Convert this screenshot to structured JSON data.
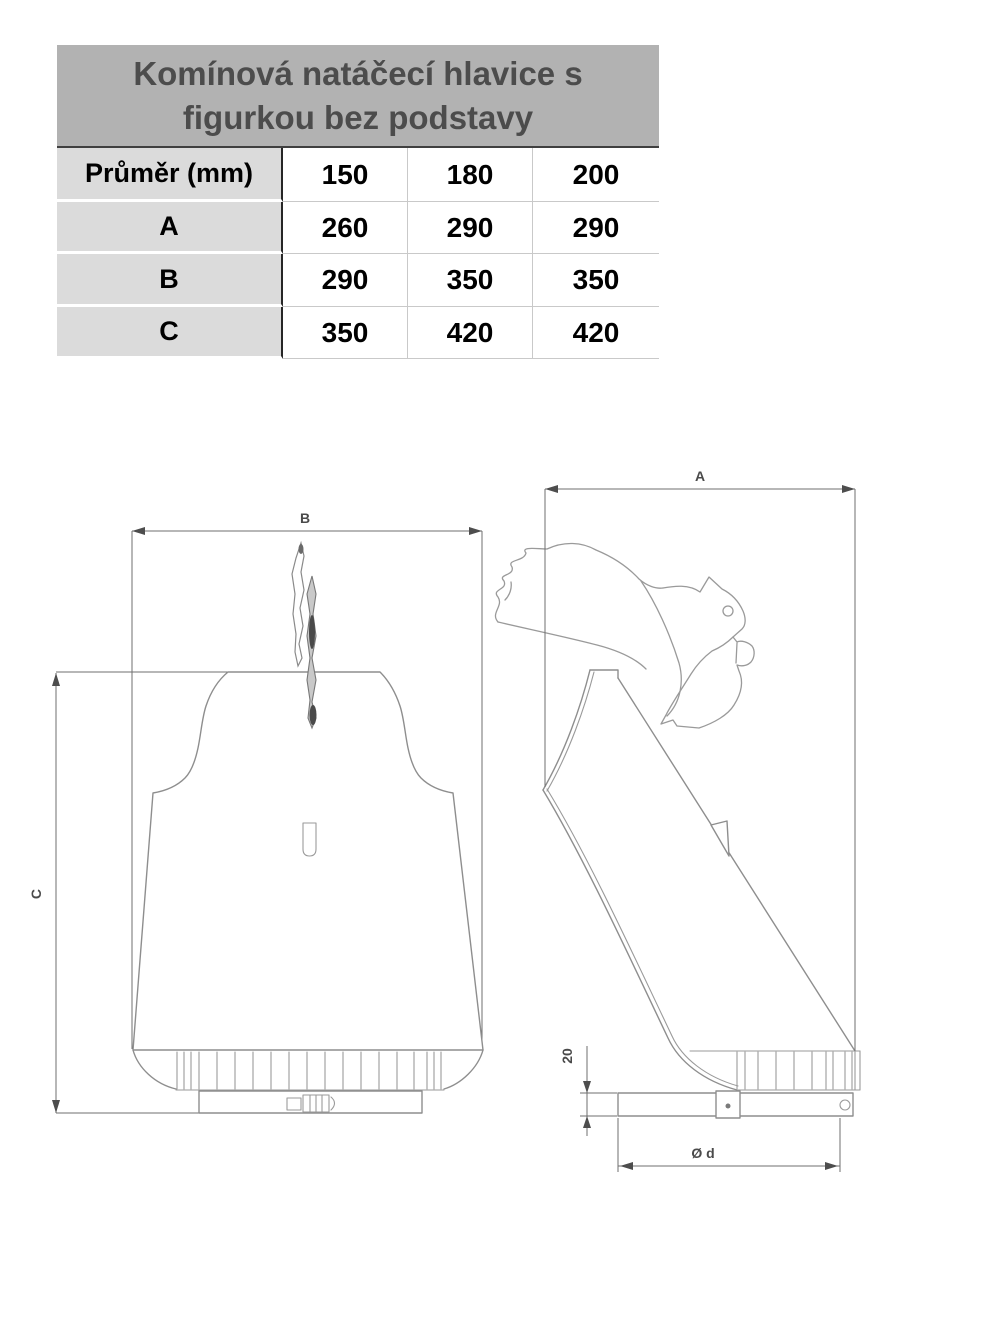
{
  "table": {
    "title": "Komínová natáčecí hlavice s figurkou bez podstavy",
    "columns_header": {
      "label": "Průměr (mm)",
      "values": [
        "150",
        "180",
        "200"
      ]
    },
    "rows": [
      {
        "label": "A",
        "values": [
          "260",
          "290",
          "290"
        ]
      },
      {
        "label": "B",
        "values": [
          "290",
          "350",
          "350"
        ]
      },
      {
        "label": "C",
        "values": [
          "350",
          "420",
          "420"
        ]
      }
    ]
  },
  "drawing": {
    "front_view": {
      "width_dim": "B",
      "height_dim": "C"
    },
    "side_view": {
      "width_dim": "A",
      "collar_height_dim": "20",
      "diameter_dim": "Ø d"
    }
  },
  "colors": {
    "table_title_bg": "#b2b2b2",
    "table_label_bg": "#dbdbdb",
    "table_title_text": "#4c4c4c",
    "drawing_line": "#8e8e8e",
    "dimension_text": "#4a4a4a"
  }
}
